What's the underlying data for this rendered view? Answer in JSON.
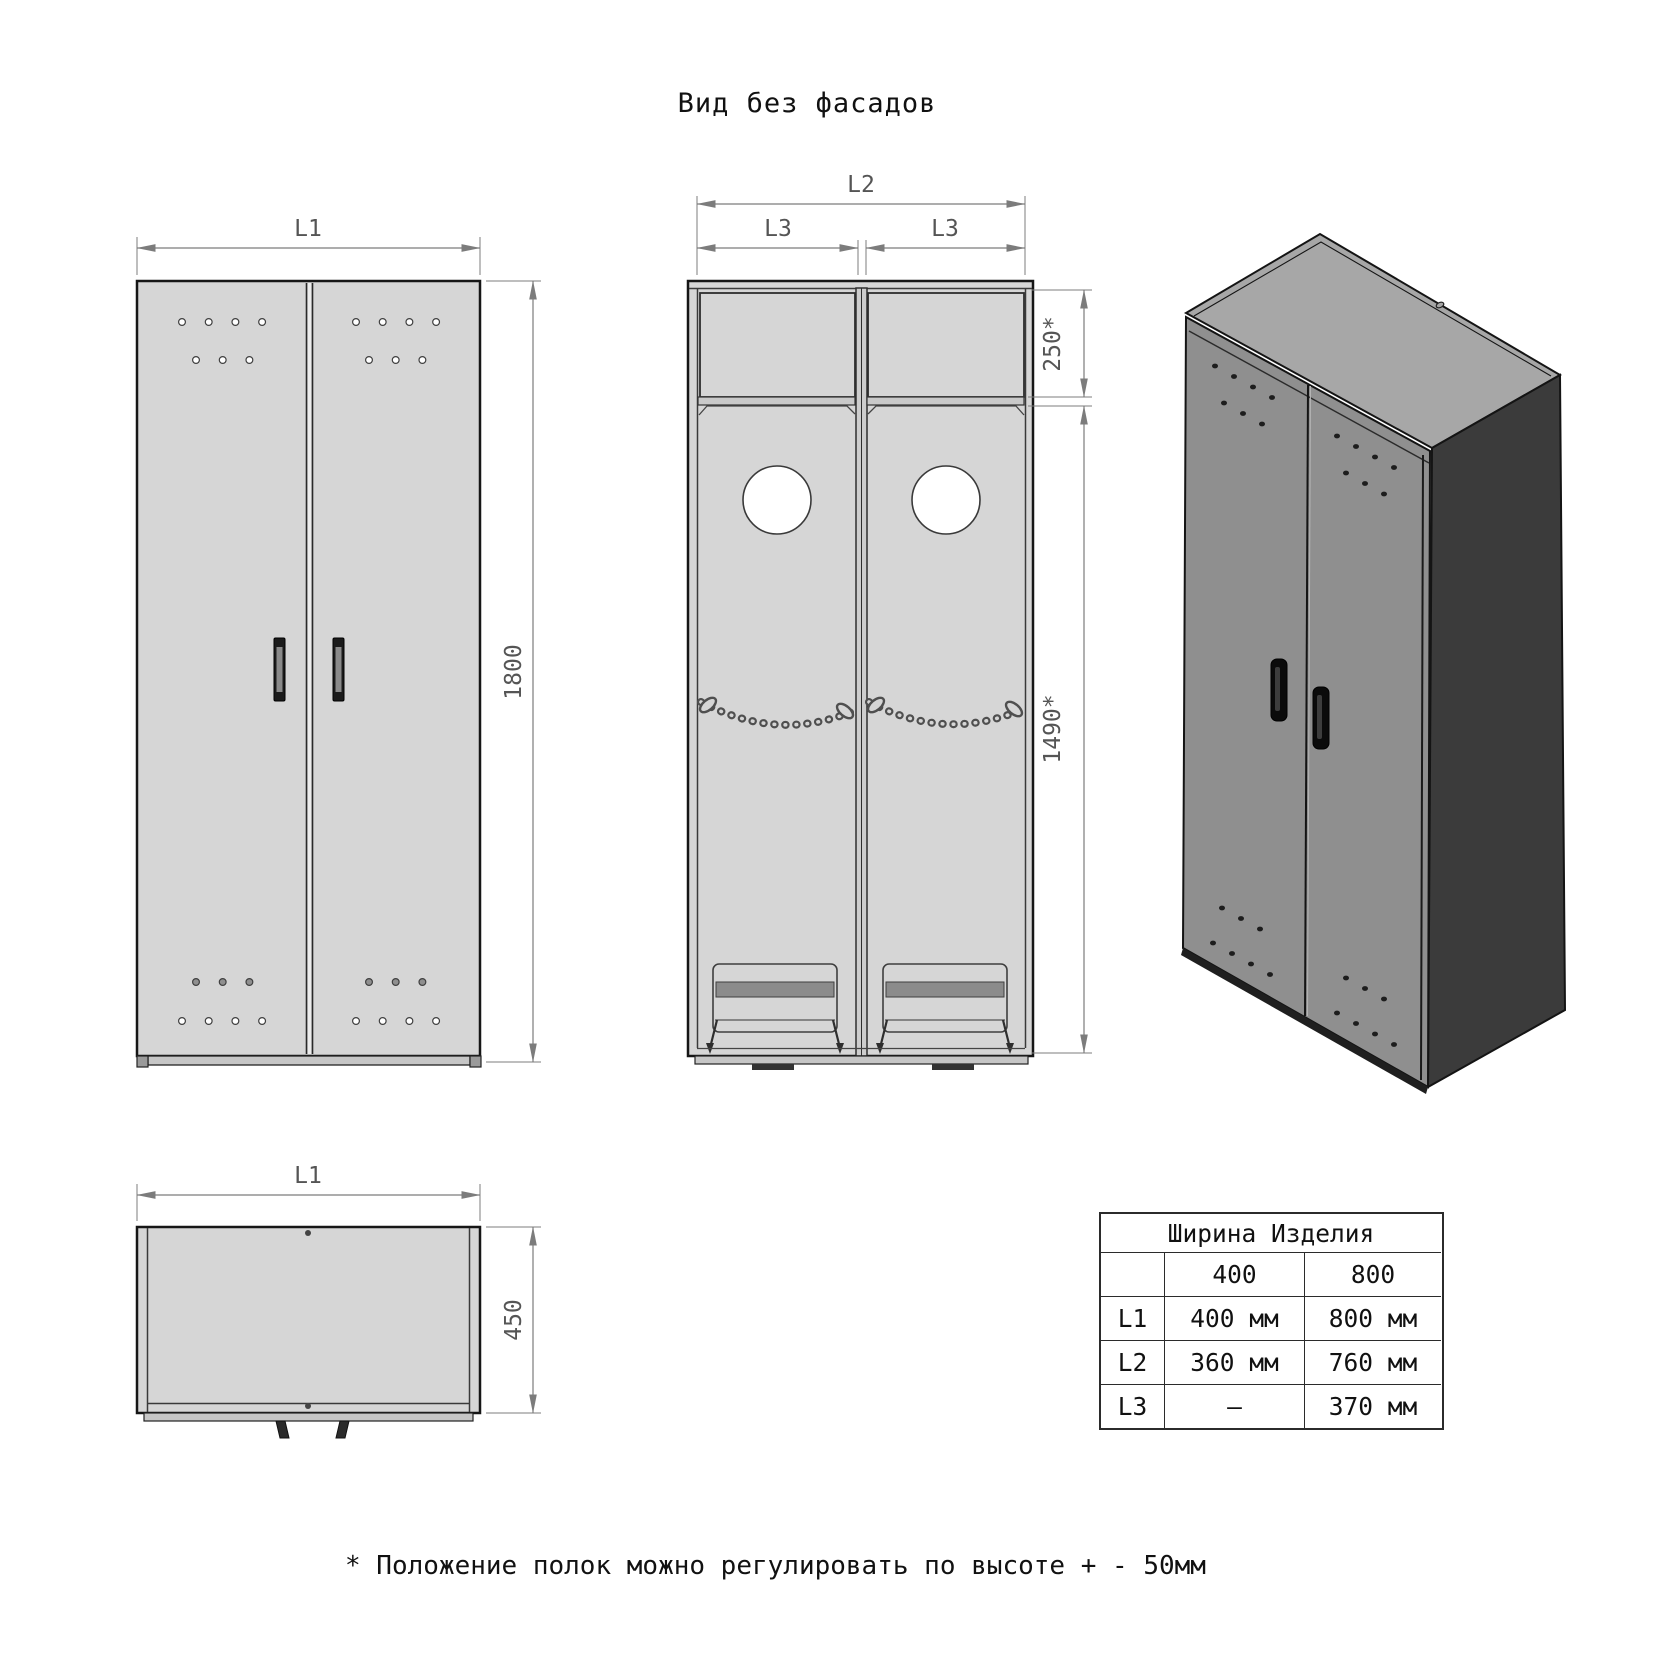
{
  "title": "Вид без фасадов",
  "footnote": "* Положение полок можно регулировать по высоте + - 50мм",
  "colors": {
    "panel": "#d6d6d6",
    "outline": "#161616",
    "dim": "#7c7c7c",
    "dimtext": "#555555",
    "front3d": "#8f8f8f",
    "top3d": "#a7a7a7",
    "side3d": "#3b3b3b"
  },
  "views": {
    "front": {
      "width_label": "L1",
      "height_label": "1800"
    },
    "carcass": {
      "width_label": "L2",
      "bay_label": "L3",
      "top_section_label": "250*",
      "main_section_label": "1490*"
    },
    "top": {
      "width_label": "L1",
      "depth_label": "450"
    }
  },
  "table": {
    "header": "Ширина Изделия",
    "columns": [
      "400",
      "800"
    ],
    "rows": [
      {
        "label": "L1",
        "values": [
          "400 мм",
          "800 мм"
        ]
      },
      {
        "label": "L2",
        "values": [
          "360 мм",
          "760 мм"
        ]
      },
      {
        "label": "L3",
        "values": [
          "–",
          "370 мм"
        ]
      }
    ]
  }
}
